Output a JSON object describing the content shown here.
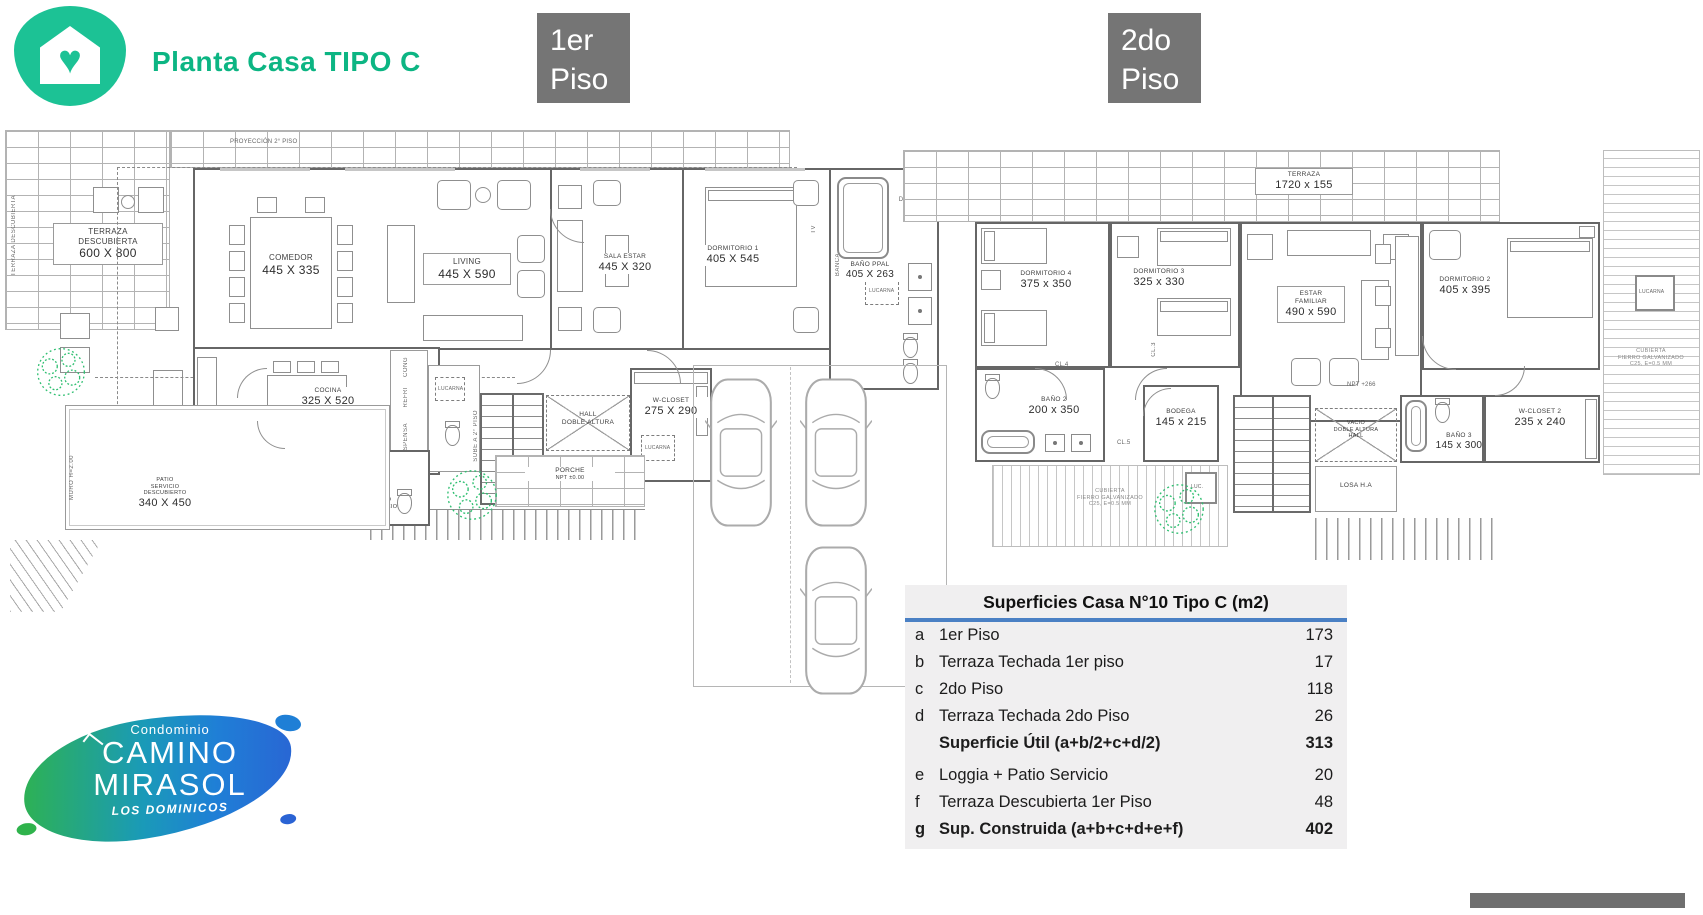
{
  "header": {
    "title": "Planta Casa TIPO C",
    "floor1_l1": "1er",
    "floor1_l2": "Piso",
    "floor2_l1": "2do",
    "floor2_l2": "Piso"
  },
  "colors": {
    "brand_green": "#1cc295",
    "title_green": "#0cb583",
    "badge_gray": "#757575",
    "table_blue": "#4a80c4",
    "wall_gray": "#6f6f6f"
  },
  "plan1": {
    "projection": "PROYECCIÓN 2° PISO",
    "terraza": {
      "n1": "TERRAZA",
      "n2": "DESCUBIERTA",
      "dims": "600 X 800",
      "side": "TERRAZA DESCUBIERTA"
    },
    "comedor": {
      "name": "COMEDOR",
      "dims": "445 X 335"
    },
    "living": {
      "name": "LIVING",
      "dims": "445 X 590"
    },
    "sala_estar": {
      "name": "SALA ESTAR",
      "dims": "445 X 320"
    },
    "dormitorio1": {
      "name": "DORMITORIO 1",
      "dims": "405 X 545"
    },
    "bano_ppal": {
      "name": "BAÑO PPAL",
      "dims": "405 X 263"
    },
    "ducha": "DUCHA EN OBRA",
    "lucarna": "LUCARNA",
    "banca": "BANCA",
    "tv": "TV",
    "cocina": {
      "name": "COCINA",
      "dims": "325 X 520"
    },
    "despensa": "DESPENSA",
    "refri": "REFRI",
    "cong": "CONG",
    "hall": {
      "l1": "HALL",
      "l2": "DOBLE ALTURA"
    },
    "sube": "SUBE A 2° PISO",
    "wcloset": {
      "name": "W-CLOSET",
      "dims": "275 X 290",
      "lucarna": "LUCARNA"
    },
    "porche": {
      "name": "PORCHE",
      "npt": "NPT ±0.00"
    },
    "patio": {
      "l1": "PATIO",
      "l2": "SERVICIO",
      "l3": "DESCUBIERTO",
      "dims": "340 X 450"
    },
    "muro": "MURO H=2.00",
    "dorm_serv": {
      "l1": "DORMITORIO",
      "l2": "SERVICIO",
      "dims": "360 X 190"
    },
    "bano_serv": {
      "l1": "BAÑO",
      "l2": "SERVICIO"
    }
  },
  "plan2": {
    "terraza": {
      "name": "TERRAZA",
      "dims": "1720 x 155"
    },
    "dormitorio4": {
      "name": "DORMITORIO 4",
      "dims": "375 x 350"
    },
    "dormitorio3": {
      "name": "DORMITORIO 3",
      "dims": "325 x 330"
    },
    "estar": {
      "l1": "ESTAR",
      "l2": "FAMILIAR",
      "dims": "490 x 590"
    },
    "dormitorio2": {
      "name": "DORMITORIO 2",
      "dims": "405 x 395"
    },
    "bano2": {
      "name": "BAÑO 2",
      "dims": "200 x 350"
    },
    "bodega": {
      "name": "BODEGA",
      "dims": "145 x 215"
    },
    "bano3": {
      "name": "BAÑO 3",
      "dims": "145 x 300"
    },
    "wcloset2": {
      "name": "W-CLOSET 2",
      "dims": "235 x 240"
    },
    "vacio": {
      "l1": "VACIO",
      "l2": "DOBLE ALTURA",
      "l3": "HALL"
    },
    "losa": "LOSA H.A",
    "npt": "NPT +266",
    "cl3": "CL.3",
    "cl4": "CL.4",
    "cl5": "CL.5",
    "lucarna": "LUCARNA",
    "luc": "LUC.",
    "cubierta": {
      "l1": "CUBIERTA",
      "l2": "FIERRO GALVANIZADO",
      "l3": "C25, E=0.5 MM"
    }
  },
  "table": {
    "title": "Superficies Casa N°10 Tipo C (m2)",
    "rows": [
      {
        "k": "a",
        "label": "1er Piso",
        "value": "173"
      },
      {
        "k": "b",
        "label": "Terraza Techada 1er piso",
        "value": "17"
      },
      {
        "k": "c",
        "label": "2do Piso",
        "value": "118"
      },
      {
        "k": "d",
        "label": "Terraza Techada 2do Piso",
        "value": "26"
      },
      {
        "k": "",
        "label": "Superficie Útil (a+b/2+c+d/2)",
        "value": "313"
      },
      {
        "k": "e",
        "label": "Loggia + Patio Servicio",
        "value": "20"
      },
      {
        "k": "f",
        "label": "Terraza Descubierta 1er Piso",
        "value": "48"
      },
      {
        "k": "g",
        "label": "Sup. Construida (a+b+c+d+e+f)",
        "value": "402"
      }
    ]
  },
  "brand": {
    "cond": "Condominio",
    "l1": "CAMINO",
    "l2": "MIRASOL",
    "sub": "LOS DOMINICOS"
  }
}
